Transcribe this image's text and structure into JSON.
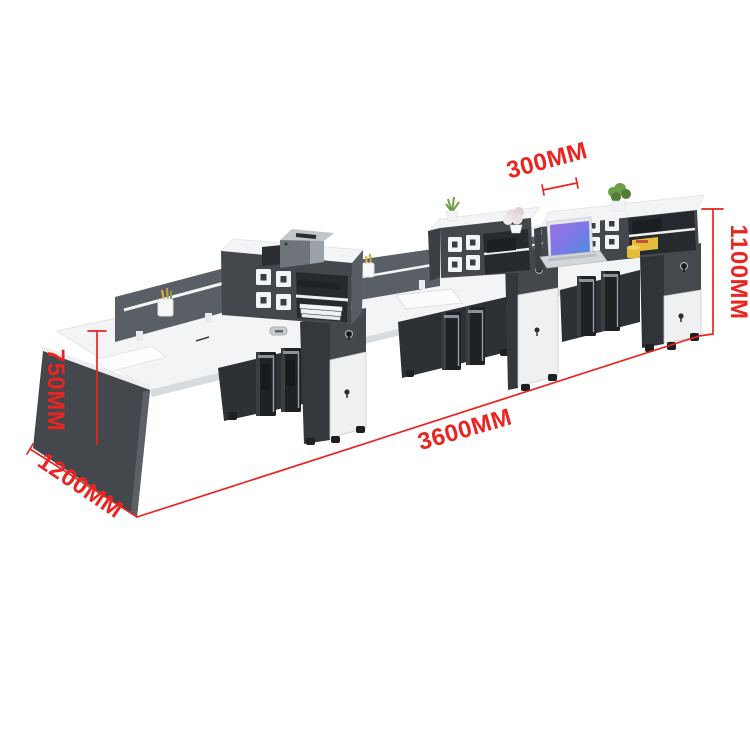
{
  "page": {
    "background": "#ffffff"
  },
  "annotations": {
    "color": "#ea2420",
    "labels": {
      "hutch_depth": "300MM",
      "total_height": "1100MM",
      "desk_height": "750MM",
      "desk_depth": "1200MM",
      "total_length": "3600MM"
    }
  },
  "scene": {
    "parts": [
      "white-desktop",
      "left-side-panel",
      "divider-screen",
      "storage-hutch",
      "door-squares",
      "open-shelves",
      "mobile-pedestal",
      "end-cabinet",
      "pc-tower",
      "printer",
      "laptop",
      "plant",
      "pen-cup",
      "mug",
      "grommet",
      "document-mat"
    ],
    "colors": {
      "page_bg": "#ffffff",
      "desk_white": "#f3f4f6",
      "edge_gray": "#d8dbde",
      "panel_dark": "#44484d",
      "panel_darker": "#303338",
      "panel_side": "#585d63",
      "cavity_dark": "#2d3034",
      "shelf_interior": "#26292d",
      "screen_gray": "#5a5f65",
      "white_front": "#eef0f2",
      "hardware_black": "#1d1f22",
      "silver": "#969da4",
      "printer_top": "#c2c6cb",
      "printer_body": "#6e747a",
      "accent_yellow": "#e3bc3a",
      "plant_green": "#6f9e4a",
      "plant_green_dark": "#567d36",
      "plant_pink": "#e8e0e3",
      "laptop_silver": "#d2d6d9",
      "screen_purple": "#9b6fe8",
      "screen_blue": "#4a8fe0"
    }
  }
}
